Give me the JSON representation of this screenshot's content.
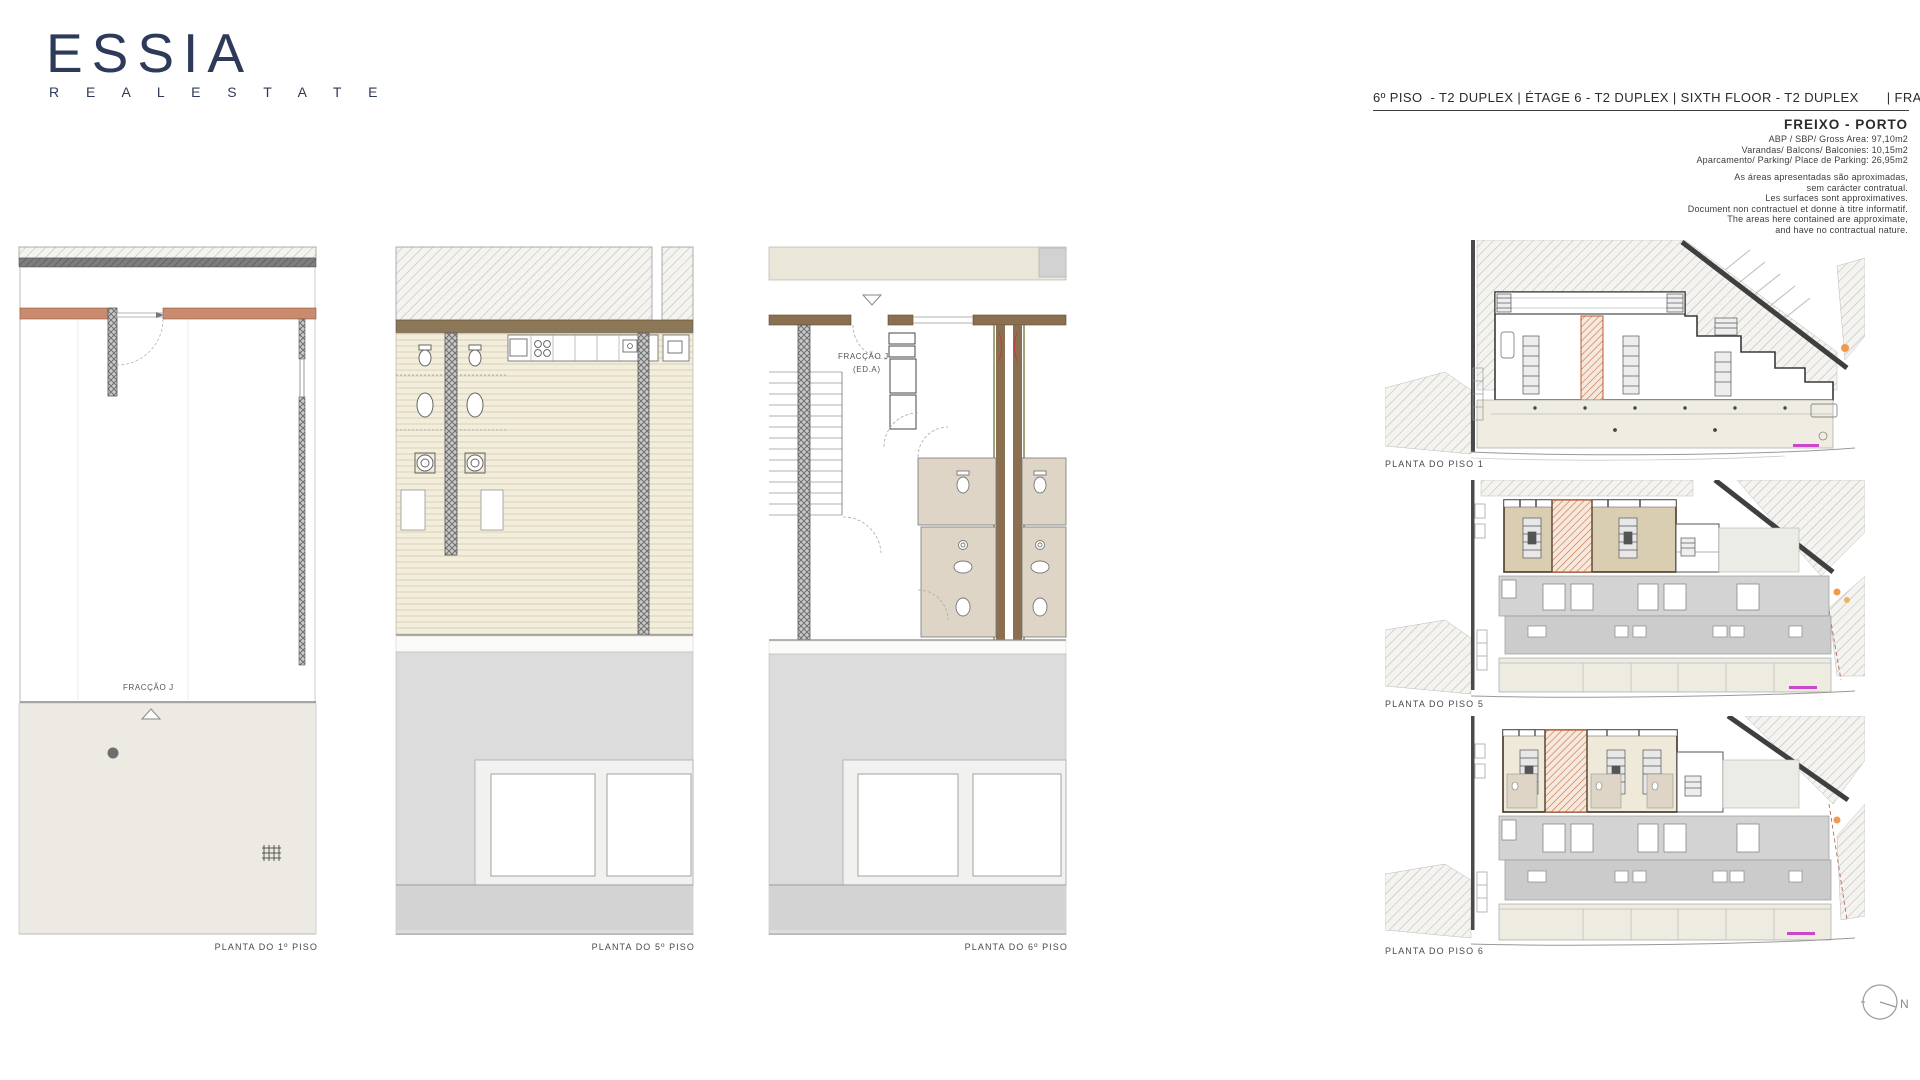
{
  "brand": {
    "name": "ESSIA",
    "tagline": "R E A L   E S T A T E"
  },
  "header": {
    "title": "6º PISO  - T2 DUPLEX | ÉTAGE 6 - T2 DUPLEX | SIXTH FLOOR - T2 DUPLEX       | FRACÇÃO J",
    "location": "FREIXO  - PORTO",
    "areas": [
      "ABP / SBP/ Gross Area: 97,10m2",
      "Varandas/ Balcons/ Balconies: 10,15m2",
      "Aparcamento/ Parking/ Place de Parking: 26,95m2"
    ],
    "disclaimer": [
      "As áreas apresentadas são aproximadas,",
      "sem carácter contratual.",
      "Les surfaces sont approximatives.",
      "Document non contractuel et donne à titre informatif.",
      "The areas here contained are approximate,",
      "and have no contractual nature."
    ]
  },
  "plans": {
    "floor1": {
      "caption": "PLANTA DO 1º PISO",
      "unit_label": "FRACÇÃO J"
    },
    "floor5": {
      "caption": "PLANTA DO 5º PISO"
    },
    "floor6": {
      "caption": "PLANTA DO 6º PISO",
      "unit_label": "FRACÇÃO J",
      "unit_label2": "(ED.A)"
    },
    "site1": {
      "caption": "PLANTA DO PISO 1"
    },
    "site5": {
      "caption": "PLANTA DO PISO 5"
    },
    "site6": {
      "caption": "PLANTA DO PISO 6"
    }
  },
  "compass": {
    "label": "N"
  },
  "colors": {
    "brand_navy": "#2e3a59",
    "wall_salmon": "#c98a6e",
    "wall_brown": "#8a6f50",
    "band_olive": "#8c7757",
    "wood_cream": "#f3eedb",
    "tile_beige": "#ded5c6",
    "roof_grey": "#d3d3d3",
    "terrace_grey": "#dcdcdc",
    "highlight_orange": "#c96f44",
    "marker_magenta": "#c429c4",
    "marker_orange": "#f09a4e"
  }
}
